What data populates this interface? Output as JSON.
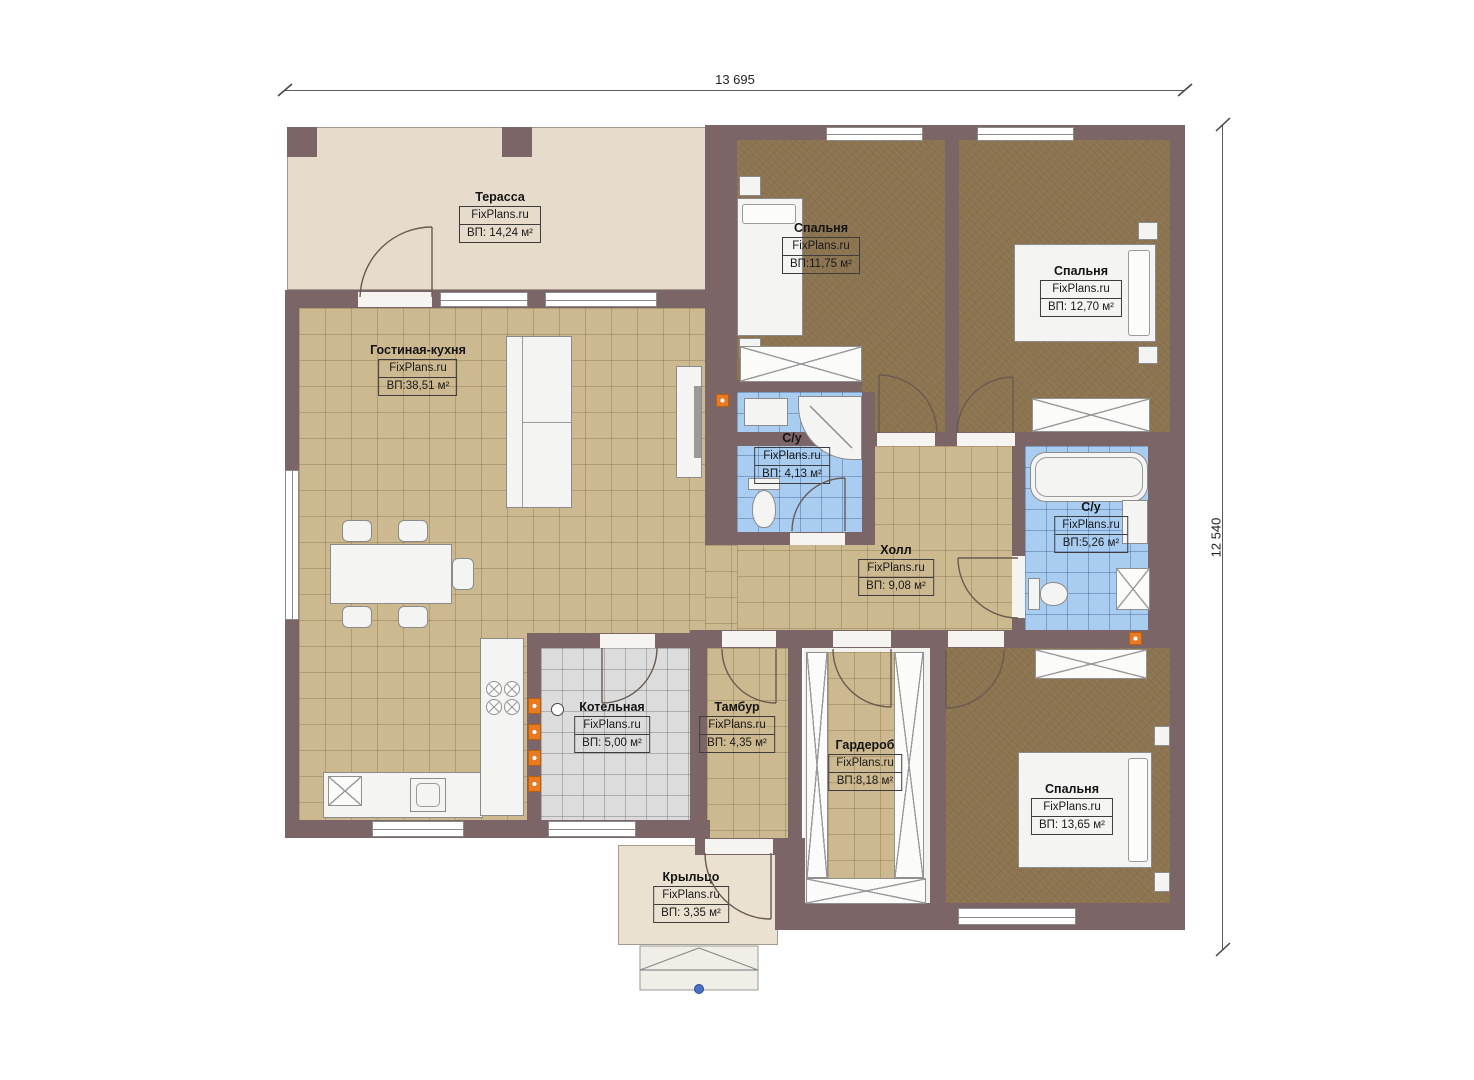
{
  "watermark": "FixPlans.ru",
  "dims": {
    "width_label": "13 695",
    "height_label": "12 540"
  },
  "rooms": [
    {
      "id": "terrace",
      "name": "Терасса",
      "watermark": "FixPlans.ru",
      "area": "ВП: 14,24 м²"
    },
    {
      "id": "living-kitchen",
      "name": "Гостиная-кухня",
      "watermark": "FixPlans.ru",
      "area": "ВП:38,51 м²"
    },
    {
      "id": "bedroom-1",
      "name": "Спальня",
      "watermark": "FixPlans.ru",
      "area": "ВП:11,75 м²"
    },
    {
      "id": "bedroom-2",
      "name": "Спальня",
      "watermark": "FixPlans.ru",
      "area": "ВП: 12,70 м²"
    },
    {
      "id": "bathroom-1",
      "name": "С/у",
      "watermark": "FixPlans.ru",
      "area": "ВП: 4,13 м²"
    },
    {
      "id": "hall",
      "name": "Холл",
      "watermark": "FixPlans.ru",
      "area": "ВП: 9,08 м²"
    },
    {
      "id": "bathroom-2",
      "name": "С/у",
      "watermark": "FixPlans.ru",
      "area": "ВП:5,26 м²"
    },
    {
      "id": "boiler-room",
      "name": "Котельная",
      "watermark": "FixPlans.ru",
      "area": "ВП: 5,00 м²"
    },
    {
      "id": "vestibule",
      "name": "Тамбур",
      "watermark": "FixPlans.ru",
      "area": "ВП: 4,35 м²"
    },
    {
      "id": "wardrobe",
      "name": "Гардероб",
      "watermark": "FixPlans.ru",
      "area": "ВП:8,18 м²"
    },
    {
      "id": "bedroom-3",
      "name": "Спальня",
      "watermark": "FixPlans.ru",
      "area": "ВП: 13,65 м²"
    },
    {
      "id": "porch",
      "name": "Крыльцо",
      "watermark": "FixPlans.ru",
      "area": "ВП: 3,35 м²"
    }
  ],
  "colors": {
    "wall": "#7b6566",
    "tile_floor": "#cdb98f",
    "carpet": "#8c7450",
    "bathroom_tile": "#a9cdf0",
    "boiler_floor": "#dcdcdc",
    "terrace_floor": "#e7dccb",
    "porch_floor": "#eae1d0",
    "accent_orange": "#e87a22",
    "marker_blue": "#4a72c4"
  }
}
